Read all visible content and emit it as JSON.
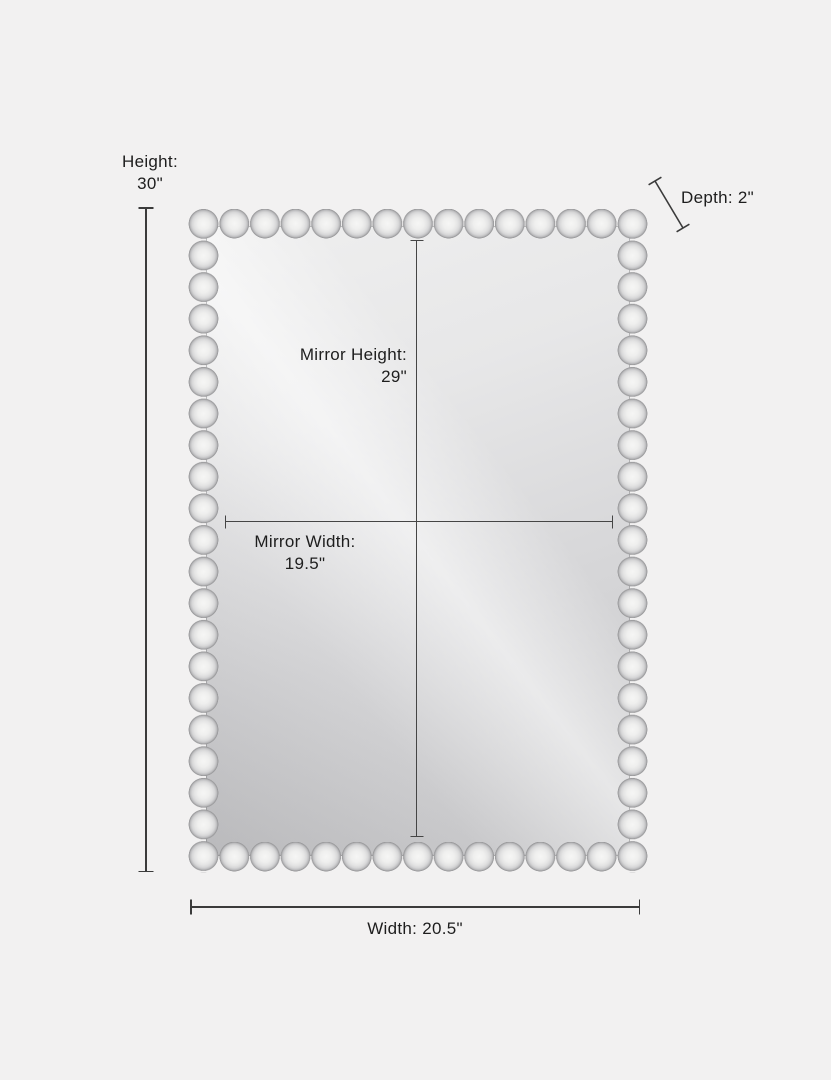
{
  "diagram": {
    "labels": {
      "height": {
        "name": "Height:",
        "value": "30\""
      },
      "depth": {
        "text": "Depth: 2\""
      },
      "mirror_height": {
        "name": "Mirror Height:",
        "value": "29\""
      },
      "mirror_width": {
        "name": "Mirror Width:",
        "value": "19.5\""
      },
      "width": {
        "text": "Width: 20.5\""
      }
    },
    "values_inches": {
      "height": 30,
      "depth": 2,
      "mirror_height": 29,
      "mirror_width": 19.5,
      "width": 20.5
    },
    "colors": {
      "background": "#f2f1f1",
      "dimension_line": "#3b3b3b",
      "text": "#1e1e1e",
      "bead_light": "#f6f6f5",
      "bead_shadow": "#939395",
      "glass_light": "#efefef",
      "glass_dark": "#c6c6c8"
    }
  }
}
